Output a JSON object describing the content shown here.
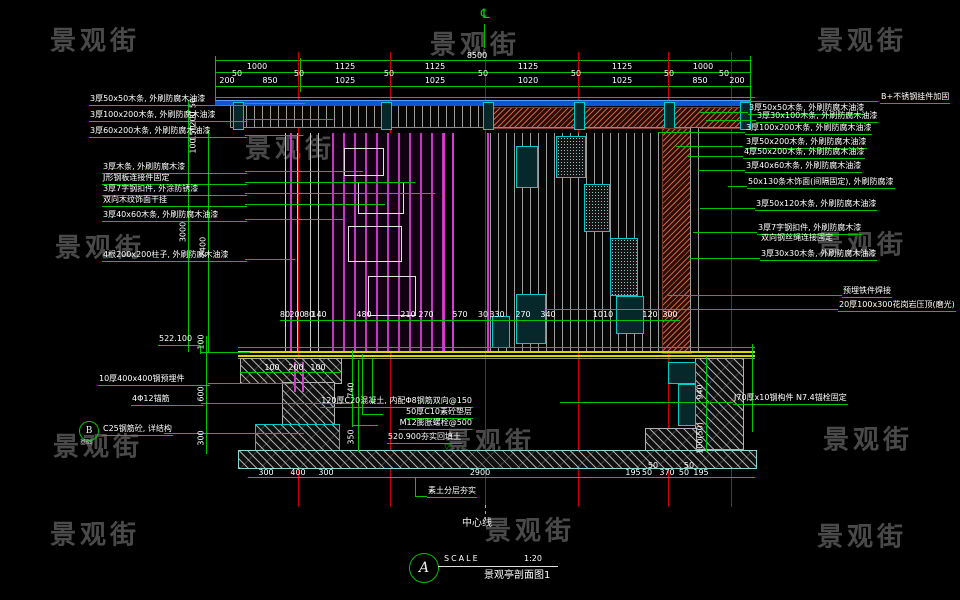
{
  "watermark": {
    "text": "景观街",
    "positions": [
      {
        "x": 95,
        "y": 42
      },
      {
        "x": 475,
        "y": 46
      },
      {
        "x": 862,
        "y": 42
      },
      {
        "x": 290,
        "y": 150
      },
      {
        "x": 100,
        "y": 249
      },
      {
        "x": 862,
        "y": 246
      },
      {
        "x": 98,
        "y": 448
      },
      {
        "x": 490,
        "y": 443
      },
      {
        "x": 868,
        "y": 441
      },
      {
        "x": 95,
        "y": 536
      },
      {
        "x": 530,
        "y": 532
      },
      {
        "x": 862,
        "y": 538
      }
    ]
  },
  "titleblock": {
    "bubble": "A",
    "scale_label": "SCALE",
    "scale_value": "1:20",
    "drawing_name": "景观亭剖面图1"
  },
  "centerline": {
    "label": "中心线",
    "symbol": "℄"
  },
  "callout_b": {
    "bubble": "B",
    "text": "C25钢筋砼, 详结构",
    "sub": "基础"
  },
  "dim_labels": [
    {
      "t": "8500",
      "x": 477,
      "y": 52
    },
    {
      "t": "1000",
      "x": 257,
      "y": 63
    },
    {
      "t": "1125",
      "x": 345,
      "y": 63
    },
    {
      "t": "1125",
      "x": 435,
      "y": 63
    },
    {
      "t": "1125",
      "x": 528,
      "y": 63
    },
    {
      "t": "1125",
      "x": 622,
      "y": 63
    },
    {
      "t": "1000",
      "x": 703,
      "y": 63
    },
    {
      "t": "200",
      "x": 227,
      "y": 77
    },
    {
      "t": "850",
      "x": 270,
      "y": 77
    },
    {
      "t": "1025",
      "x": 345,
      "y": 77
    },
    {
      "t": "1025",
      "x": 435,
      "y": 77
    },
    {
      "t": "1020",
      "x": 528,
      "y": 77
    },
    {
      "t": "1025",
      "x": 622,
      "y": 77
    },
    {
      "t": "850",
      "x": 700,
      "y": 77
    },
    {
      "t": "200",
      "x": 737,
      "y": 77
    },
    {
      "t": "50",
      "x": 237,
      "y": 70
    },
    {
      "t": "50",
      "x": 299,
      "y": 70
    },
    {
      "t": "50",
      "x": 389,
      "y": 70
    },
    {
      "t": "50",
      "x": 483,
      "y": 70
    },
    {
      "t": "50",
      "x": 576,
      "y": 70
    },
    {
      "t": "50",
      "x": 669,
      "y": 70
    },
    {
      "t": "50",
      "x": 724,
      "y": 70
    },
    {
      "t": "80",
      "x": 285,
      "y": 311
    },
    {
      "t": "200",
      "x": 297,
      "y": 311
    },
    {
      "t": "80",
      "x": 309,
      "y": 311
    },
    {
      "t": "140",
      "x": 319,
      "y": 311
    },
    {
      "t": "480",
      "x": 364,
      "y": 311
    },
    {
      "t": "210",
      "x": 408,
      "y": 311
    },
    {
      "t": "270",
      "x": 426,
      "y": 311
    },
    {
      "t": "570",
      "x": 460,
      "y": 311
    },
    {
      "t": "30",
      "x": 483,
      "y": 311
    },
    {
      "t": "330",
      "x": 497,
      "y": 311
    },
    {
      "t": "270",
      "x": 523,
      "y": 311
    },
    {
      "t": "340",
      "x": 548,
      "y": 311
    },
    {
      "t": "1010",
      "x": 603,
      "y": 311
    },
    {
      "t": "120",
      "x": 650,
      "y": 311
    },
    {
      "t": "300",
      "x": 670,
      "y": 311
    },
    {
      "t": "100",
      "x": 272,
      "y": 364
    },
    {
      "t": "200",
      "x": 296,
      "y": 364
    },
    {
      "t": "100",
      "x": 318,
      "y": 364
    },
    {
      "t": "300",
      "x": 266,
      "y": 469
    },
    {
      "t": "400",
      "x": 298,
      "y": 469
    },
    {
      "t": "300",
      "x": 326,
      "y": 469
    },
    {
      "t": "2900",
      "x": 480,
      "y": 469
    },
    {
      "t": "195",
      "x": 633,
      "y": 469
    },
    {
      "t": "50",
      "x": 647,
      "y": 469
    },
    {
      "t": "370",
      "x": 667,
      "y": 469
    },
    {
      "t": "50",
      "x": 684,
      "y": 469
    },
    {
      "t": "195",
      "x": 701,
      "y": 469
    },
    {
      "t": "50",
      "x": 653,
      "y": 462
    },
    {
      "t": "50",
      "x": 689,
      "y": 462
    },
    {
      "t": "50",
      "x": 194,
      "y": 103,
      "c": "dimv"
    },
    {
      "t": "200",
      "x": 194,
      "y": 119,
      "c": "dimv"
    },
    {
      "t": "150",
      "x": 194,
      "y": 133,
      "c": "dimv"
    },
    {
      "t": "100",
      "x": 194,
      "y": 146,
      "c": "dimv"
    },
    {
      "t": "3000",
      "x": 184,
      "y": 232,
      "c": "dimv"
    },
    {
      "t": "2400",
      "x": 204,
      "y": 247,
      "c": "dimv"
    },
    {
      "t": "100",
      "x": 202,
      "y": 342,
      "c": "dimv"
    },
    {
      "t": "600",
      "x": 202,
      "y": 394,
      "c": "dimv"
    },
    {
      "t": "300",
      "x": 202,
      "y": 438,
      "c": "dimv"
    },
    {
      "t": "740",
      "x": 352,
      "y": 390,
      "c": "dimv"
    },
    {
      "t": "350",
      "x": 352,
      "y": 437,
      "c": "dimv"
    },
    {
      "t": "940",
      "x": 701,
      "y": 392,
      "c": "dimv"
    },
    {
      "t": "100(50)",
      "x": 701,
      "y": 438,
      "c": "dimv"
    },
    {
      "t": "▽",
      "x": 200,
      "y": 341,
      "c": "grn"
    },
    {
      "t": "▽",
      "x": 447,
      "y": 444,
      "c": "grn"
    }
  ],
  "annotations_left": [
    {
      "t": "3厚50x50木条, 外刷防腐木油漆",
      "x": 89,
      "y": 95,
      "w": 156
    },
    {
      "t": "3厚100x200木条, 外刷防腐木油漆",
      "x": 89,
      "y": 111,
      "w": 156
    },
    {
      "t": "3厚60x200木条, 外刷防腐木油漆",
      "x": 89,
      "y": 127,
      "w": 156
    },
    {
      "t": "3厚木条, 外刷防腐木漆",
      "x": 102,
      "y": 163,
      "w": 143
    },
    {
      "t": "J形钢板连接件固定",
      "x": 102,
      "y": 174,
      "w": 143
    },
    {
      "t": "3厚7字钢扣件, 外涂防锈漆",
      "x": 102,
      "y": 185,
      "w": 143
    },
    {
      "t": "双向木纹饰面干挂",
      "x": 102,
      "y": 196,
      "w": 143
    },
    {
      "t": "3厚40x60木条, 外刷防腐木油漆",
      "x": 102,
      "y": 211,
      "w": 143
    },
    {
      "t": "4根200x200柱子, 外刷防腐木油漆",
      "x": 102,
      "y": 251,
      "w": 143
    },
    {
      "t": "522.100",
      "x": 158,
      "y": 335,
      "w": 40
    },
    {
      "t": "10厚400x400钢预埋件",
      "x": 98,
      "y": 375,
      "w": 110
    },
    {
      "t": "4Φ12锚筋",
      "x": 131,
      "y": 395,
      "w": 70
    }
  ],
  "annotations_right": [
    {
      "t": "B+不锈钢挂件加固",
      "x": 880,
      "y": 93
    },
    {
      "t": "3厚50x50木条, 外刷防腐木油漆",
      "x": 748,
      "y": 104
    },
    {
      "t": "3厚30x100木条, 外刷防腐木油漆",
      "x": 756,
      "y": 112
    },
    {
      "t": "3厚100x200木条, 外刷防腐木油漆",
      "x": 745,
      "y": 124
    },
    {
      "t": "3厚50x200木条, 外刷防腐木油漆",
      "x": 745,
      "y": 138
    },
    {
      "t": "4厚50x200木条, 外刷防腐木油漆",
      "x": 743,
      "y": 148
    },
    {
      "t": "3厚40x60木条, 外刷防腐木油漆",
      "x": 745,
      "y": 162
    },
    {
      "t": "50x130条木饰面(间隔固定), 外刷防腐漆",
      "x": 747,
      "y": 178
    },
    {
      "t": "3厚50x120木条, 外刷防腐木油漆",
      "x": 755,
      "y": 200
    },
    {
      "t": "3厚7字钢扣件, 外刷防腐木漆",
      "x": 757,
      "y": 224
    },
    {
      "t": "双向钢丝绳连接固定",
      "x": 760,
      "y": 234,
      "c": "annP"
    },
    {
      "t": "3厚30x30木条, 外刷防腐木油漆",
      "x": 760,
      "y": 250
    },
    {
      "t": "预埋铁件焊接",
      "x": 842,
      "y": 287
    },
    {
      "t": "20厚100x300花岗岩压顶(磨光)",
      "x": 838,
      "y": 301
    },
    {
      "t": "J70厚x10钢构件 N7.4锚栓固定",
      "x": 733,
      "y": 394
    },
    {
      "t": "素土分层夯实",
      "x": 427,
      "y": 487
    }
  ],
  "annotations_mid": [
    {
      "t": "120厚C20混凝土, 内配Φ8钢筋双向@150",
      "x": 473,
      "y": 397
    },
    {
      "t": "50厚C10素砼垫层",
      "x": 473,
      "y": 408
    },
    {
      "t": "M12膨胀螺栓@500",
      "x": 473,
      "y": 419
    },
    {
      "t": "520.900夯实回填土",
      "x": 462,
      "y": 433
    }
  ]
}
